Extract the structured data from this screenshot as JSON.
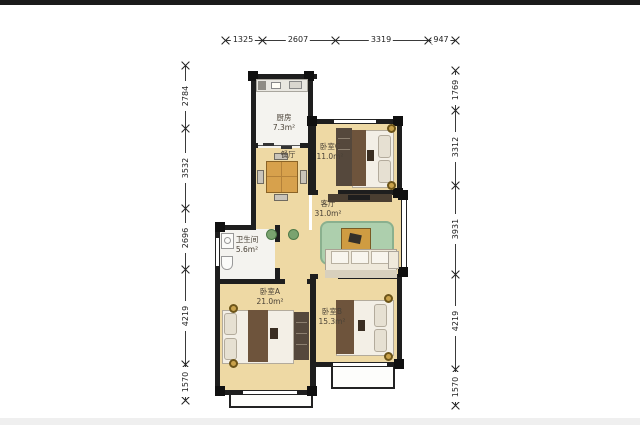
{
  "image": {
    "type": "apartment-floorplan",
    "colors": {
      "wall": "#1e1e1e",
      "wood_floor": "#eed9a4",
      "tile_floor": "#f4f3ef",
      "rug_green": "#adcfad",
      "furniture_brown": "#6e543c",
      "accent_gold": "#c9a24b"
    }
  },
  "rooms": {
    "kitchen": {
      "name": "厨房",
      "area": "7.3m²"
    },
    "dining": {
      "name": "餐厅"
    },
    "bedroom_c": {
      "name": "卧室C",
      "area": "11.0m²"
    },
    "living": {
      "name": "客厅",
      "area": "31.0m²"
    },
    "bathroom": {
      "name": "卫生间",
      "area": "5.6m²"
    },
    "bedroom_a": {
      "name": "卧室A",
      "area": "21.0m²"
    },
    "bedroom_b": {
      "name": "卧室B",
      "area": "15.3m²"
    }
  },
  "dimensions": {
    "top": [
      "1325",
      "2607",
      "3319",
      "947"
    ],
    "left": [
      "2784",
      "3532",
      "2696",
      "4219",
      "1570"
    ],
    "right": [
      "1769",
      "3312",
      "3931",
      "4219",
      "1570"
    ]
  }
}
